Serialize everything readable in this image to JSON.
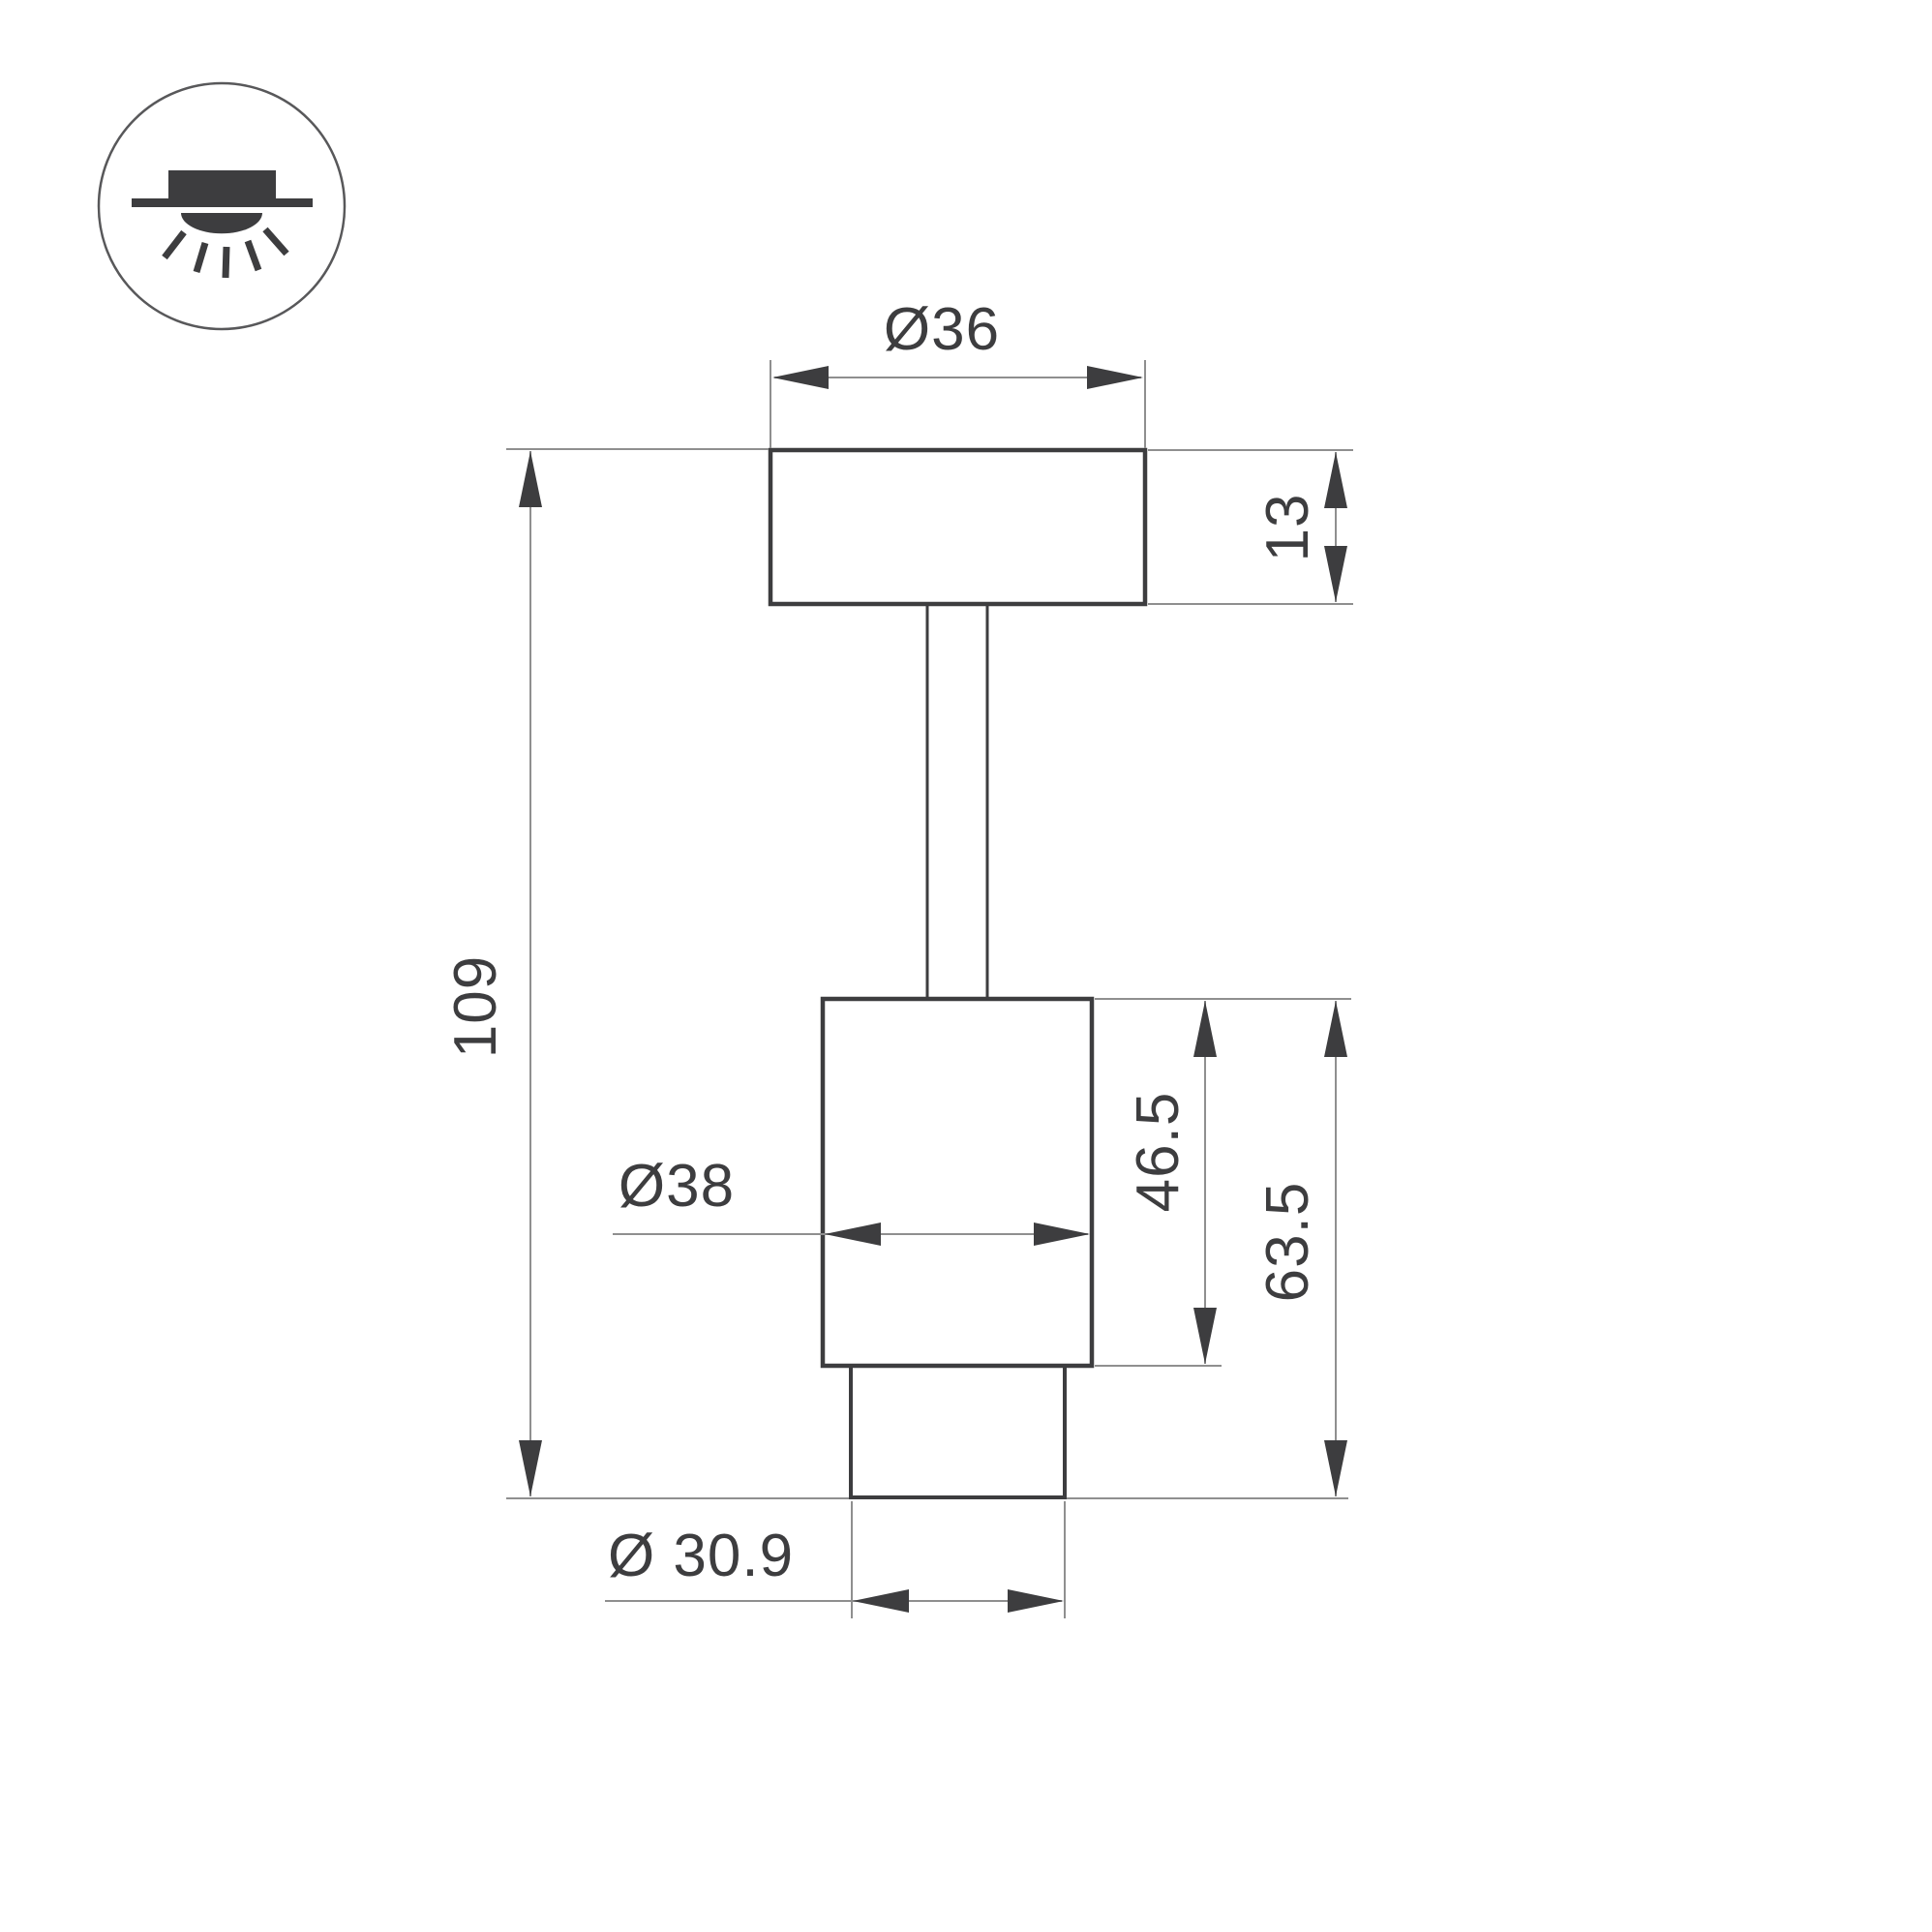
{
  "icon": {
    "name": "ceiling-downlight-icon"
  },
  "dimensions": {
    "top_diameter": "Ø36",
    "plate_thickness": "13",
    "overall_height": "109",
    "body_diameter": "Ø38",
    "body_height": "46.5",
    "body_and_trim_height": "63.5",
    "trim_diameter": "Ø 30.9"
  },
  "colors": {
    "outline": "#3d3d3f",
    "dimension_line": "#8f8f8f",
    "text": "#3d3d3f",
    "background": "#ffffff"
  }
}
